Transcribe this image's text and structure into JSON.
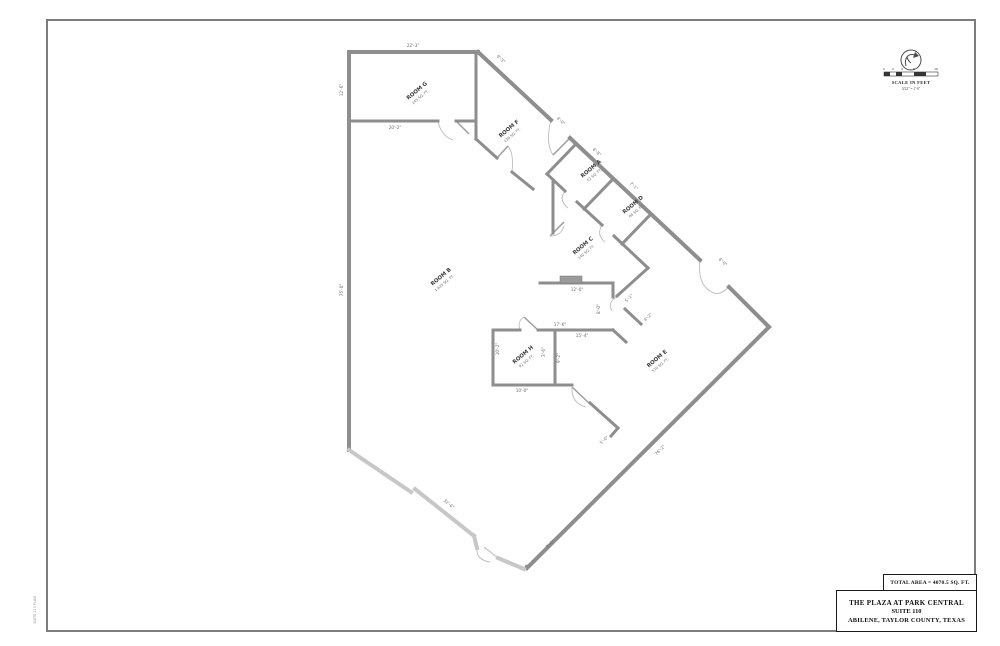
{
  "sheet": {
    "bg": "#ffffff",
    "border_color": "#7d7d7d"
  },
  "colors": {
    "wall": "#8e8e8e",
    "storefront": "#c7c7c7",
    "dim_text": "#6a6a6a",
    "label_text": "#3c3c3c"
  },
  "scale_block": {
    "title": "SCALE IN FEET",
    "ratio": "3/32\" = 1'-0\"",
    "ticks": [
      "0",
      "2",
      "4",
      "8",
      "16"
    ]
  },
  "total_area": "TOTAL AREA = 4070.5 SQ. FT.",
  "title_block": {
    "line1": "THE PLAZA AT PARK CENTRAL",
    "line2": "SUITE 110",
    "line3": "ABILENE, TAYLOR COUNTY, TEXAS"
  },
  "margin_note": "SUITE 110 PLAN",
  "rooms": [
    {
      "label": "ROOM G",
      "area": "245 SQ. FT."
    },
    {
      "label": "ROOM F",
      "area": "130 SQ. FT."
    },
    {
      "label": "ROOM A",
      "area": "52 SQ. FT."
    },
    {
      "label": "ROOM D",
      "area": "68 SQ. FT."
    },
    {
      "label": "ROOM C",
      "area": "140 SQ. FT."
    },
    {
      "label": "ROOM B",
      "area": "1,635 SQ. FT."
    },
    {
      "label": "ROOM H",
      "area": "92 SQ. FT."
    },
    {
      "label": "ROOM E",
      "area": "570 SQ. FT."
    }
  ],
  "dims": [
    {
      "t": "22'-3\""
    },
    {
      "t": "9'-3\""
    },
    {
      "t": "12'-6\""
    },
    {
      "t": "20'-2\""
    },
    {
      "t": "75'-0\""
    },
    {
      "t": "32'-6\""
    },
    {
      "t": "4'-0\""
    },
    {
      "t": "6'-8\""
    },
    {
      "t": "7'-1\""
    },
    {
      "t": "6'-0\""
    },
    {
      "t": "12'-0\""
    },
    {
      "t": "8'-0\""
    },
    {
      "t": "17'-6\""
    },
    {
      "t": "15'-4\""
    },
    {
      "t": "5'-1\""
    },
    {
      "t": "4'-2\""
    },
    {
      "t": "10'-2\""
    },
    {
      "t": "9'-2\""
    },
    {
      "t": "10'-0\""
    },
    {
      "t": "3'-6\""
    },
    {
      "t": "5'-0\""
    },
    {
      "t": "3'-0\""
    },
    {
      "t": "76'-2\""
    }
  ]
}
